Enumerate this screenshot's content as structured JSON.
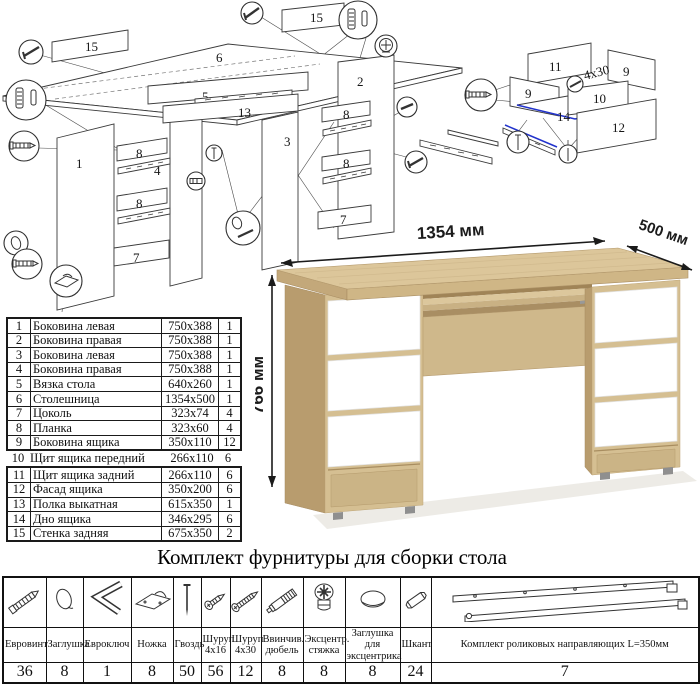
{
  "assembled_view": {
    "width_label": "1354 мм",
    "depth_label": "500 мм",
    "height_label": "766 мм"
  },
  "parts_table": {
    "rows": [
      {
        "num": "1",
        "name": "Боковина левая",
        "size": "750x388",
        "qty": "1"
      },
      {
        "num": "2",
        "name": "Боковина правая",
        "size": "750x388",
        "qty": "1"
      },
      {
        "num": "3",
        "name": "Боковина левая",
        "size": "750x388",
        "qty": "1"
      },
      {
        "num": "4",
        "name": "Боковина правая",
        "size": "750x388",
        "qty": "1"
      },
      {
        "num": "5",
        "name": "Вязка стола",
        "size": "640x260",
        "qty": "1"
      },
      {
        "num": "6",
        "name": "Столешница",
        "size": "1354x500",
        "qty": "1"
      },
      {
        "num": "7",
        "name": "Цоколь",
        "size": "323x74",
        "qty": "4"
      },
      {
        "num": "8",
        "name": "Планка",
        "size": "323x60",
        "qty": "4"
      },
      {
        "num": "9",
        "name": "Боковина ящика",
        "size": "350x110",
        "qty": "12"
      },
      {
        "num": "10",
        "name": "Щит ящика передний",
        "size": "266x110",
        "qty": "6"
      },
      {
        "num": "11",
        "name": "Щит ящика задний",
        "size": "266x110",
        "qty": "6"
      },
      {
        "num": "12",
        "name": "Фасад ящика",
        "size": "350x200",
        "qty": "6"
      },
      {
        "num": "13",
        "name": "Полка выкатная",
        "size": "615x350",
        "qty": "1"
      },
      {
        "num": "14",
        "name": "Дно ящика",
        "size": "346x295",
        "qty": "6"
      },
      {
        "num": "15",
        "name": "Стенка задняя",
        "size": "675x350",
        "qty": "2"
      }
    ]
  },
  "kit": {
    "title": "Комплект фурнитуры для сборки стола",
    "items": [
      {
        "name": "Евровинт",
        "qty": "36",
        "icon": "confirmat-screw-icon"
      },
      {
        "name": "Заглушка",
        "qty": "8",
        "icon": "screw-cap-icon"
      },
      {
        "name": "Евроключ",
        "qty": "1",
        "icon": "hex-key-icon"
      },
      {
        "name": "Ножка",
        "qty": "8",
        "icon": "plastic-foot-icon"
      },
      {
        "name": "Гвоздь",
        "qty": "50",
        "icon": "nail-icon"
      },
      {
        "name": "Шуруп 4x16",
        "qty": "56",
        "icon": "screw-4x16-icon"
      },
      {
        "name": "Шуруп 4x30",
        "qty": "12",
        "icon": "screw-4x30-icon"
      },
      {
        "name": "Ввинчив. дюбель",
        "qty": "8",
        "icon": "screw-in-dowel-icon"
      },
      {
        "name": "Эксцентр. стяжка",
        "qty": "8",
        "icon": "cam-lock-icon"
      },
      {
        "name": "Заглушка для эксцентрика",
        "qty": "8",
        "icon": "cam-cap-icon"
      },
      {
        "name": "Шкант",
        "qty": "24",
        "icon": "wood-dowel-icon"
      },
      {
        "name": "Комплект роликовых направляющих L=350мм",
        "qty": "7",
        "icon": "roller-slides-icon"
      }
    ]
  },
  "diagram": {
    "nums": {
      "n1": "1",
      "n2": "2",
      "n3": "3",
      "n4": "4",
      "n5": "5",
      "n6": "6",
      "n7": "7",
      "n8": "8",
      "n9": "9",
      "n10": "10",
      "n11": "11",
      "n12": "12",
      "n13": "13",
      "n14": "14",
      "n15": "15"
    },
    "screw_note": "4x30"
  },
  "colors": {
    "oak_top": "#dcc69a",
    "oak_front": "#d5bf92",
    "oak_side": "#b89c6e",
    "oak_shadow": "#a98e63",
    "drawer_white": "#ffffff",
    "line": "#3a3a3a",
    "blue_highlight": "#2233cc",
    "dimension_text": "#1b1b1b"
  }
}
